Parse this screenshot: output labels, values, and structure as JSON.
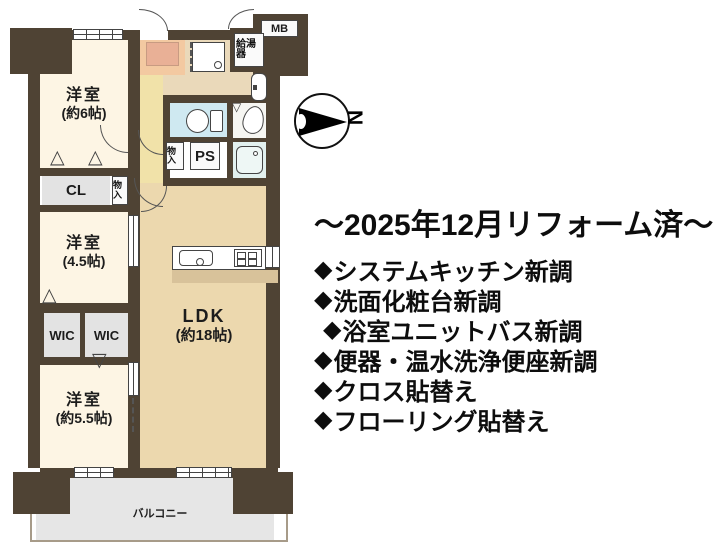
{
  "headline": {
    "text": "～2025年12月リフォーム済～"
  },
  "renovations": {
    "bullet": "◆",
    "items": [
      {
        "text": "システムキッチン新調"
      },
      {
        "text": "洗面化粧台新調"
      },
      {
        "text": "浴室ユニットバス新調"
      },
      {
        "text": "便器・温水洗浄便座新調"
      },
      {
        "text": "クロス貼替え"
      },
      {
        "text": "フローリング貼替え"
      }
    ]
  },
  "floorplan": {
    "rooms": {
      "bedroom6": {
        "name": "洋室",
        "size": "(約6帖)"
      },
      "bedroom45": {
        "name": "洋室",
        "size": "(4.5帖)"
      },
      "bedroom55": {
        "name": "洋室",
        "size": "(約5.5帖)"
      },
      "ldk": {
        "name": "LDK",
        "size": "(約18帖)"
      }
    },
    "labels": {
      "cl": "CL",
      "wic_left": "WIC",
      "wic_right": "WIC",
      "ps": "PS",
      "mb": "MB",
      "water_heater": "給湯器",
      "storage_upper": "物入",
      "storage_lower": "物入",
      "balcony": "バルコニー"
    },
    "compass": {
      "north": "N"
    },
    "colors": {
      "wall": "#4f4334",
      "bedroom": "#fdf5e4",
      "ldk": "#ecd8ae",
      "hallway": "#f1e2a9",
      "entrance": "#f3c9a1",
      "toilet": "#cfe9f1",
      "bath": "#e2f1ef",
      "closet_gray": "#e3e3e3",
      "balcony": "#e6e6e6",
      "counter_step": "#d8c29a"
    }
  }
}
